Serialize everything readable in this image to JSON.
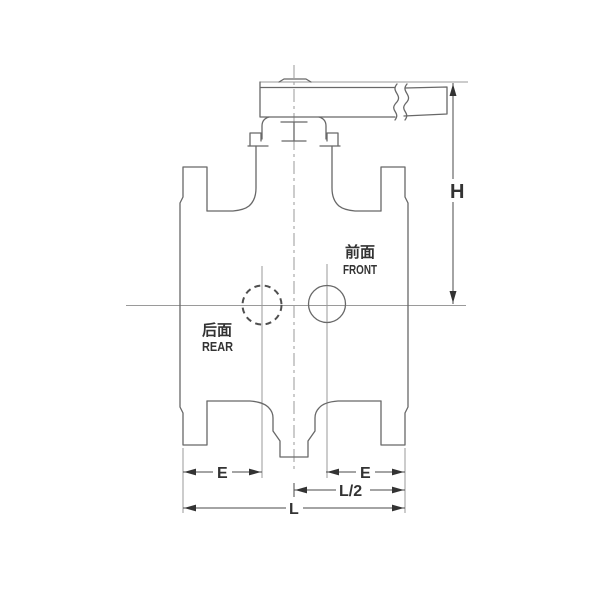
{
  "drawing": {
    "type": "valve-engineering-drawing",
    "annotations": {
      "front": {
        "cn": "前面",
        "en": "FRONT"
      },
      "rear": {
        "cn": "后面",
        "en": "REAR"
      }
    },
    "dimensions": {
      "height": "H",
      "left_end": "E",
      "right_end": "E",
      "half_length": "L/2",
      "length": "L"
    },
    "colors": {
      "background": "#ffffff",
      "outline": "#686868",
      "centerline": "#9a9a9a",
      "dimension_line": "#4a4a4a",
      "text": "#333333"
    }
  }
}
